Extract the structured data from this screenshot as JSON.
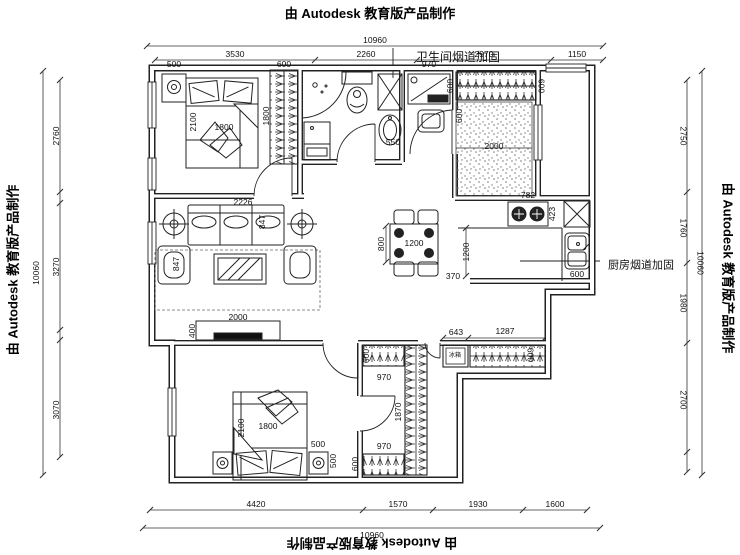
{
  "watermark": {
    "text": "由 Autodesk 教育版产品制作"
  },
  "annotations": {
    "bathroom_flue": "卫生间烟道加固",
    "kitchen_flue": "厨房烟道加固",
    "fridge": "冰箱"
  },
  "dimensions": {
    "top": {
      "total": "10960",
      "segments": [
        "3530",
        "2260",
        "2970",
        "1150"
      ]
    },
    "bottom": {
      "total": "10960",
      "segments": [
        "4420",
        "1570",
        "1930",
        "1600"
      ]
    },
    "left": {
      "total": "10060",
      "segments": [
        "2760",
        "3270",
        "3070"
      ]
    },
    "right": {
      "total": "10060",
      "segments": [
        "2750",
        "1760",
        "1980",
        "2700"
      ]
    }
  },
  "plan_labels": [
    {
      "t": "10960",
      "x": 375,
      "y": 40
    },
    {
      "t": "3530",
      "x": 235,
      "y": 54
    },
    {
      "t": "2260",
      "x": 366,
      "y": 54
    },
    {
      "t": "2970",
      "x": 484,
      "y": 54
    },
    {
      "t": "1150",
      "x": 577,
      "y": 54
    },
    {
      "t": "4420",
      "x": 256,
      "y": 504
    },
    {
      "t": "1570",
      "x": 398,
      "y": 504
    },
    {
      "t": "1930",
      "x": 478,
      "y": 504
    },
    {
      "t": "1600",
      "x": 555,
      "y": 504
    },
    {
      "t": "10960",
      "x": 372,
      "y": 535
    },
    {
      "t": "10060",
      "x": 36,
      "y": 273,
      "r": -90
    },
    {
      "t": "2760",
      "x": 56,
      "y": 136,
      "r": -90
    },
    {
      "t": "3270",
      "x": 56,
      "y": 267,
      "r": -90
    },
    {
      "t": "3070",
      "x": 56,
      "y": 410,
      "r": -90
    },
    {
      "t": "2750",
      "x": 683,
      "y": 136,
      "r": 90
    },
    {
      "t": "1760",
      "x": 683,
      "y": 228,
      "r": 90
    },
    {
      "t": "1980",
      "x": 683,
      "y": 303,
      "r": 90
    },
    {
      "t": "2700",
      "x": 683,
      "y": 400,
      "r": 90
    },
    {
      "t": "10060",
      "x": 700,
      "y": 263,
      "r": 90
    },
    {
      "t": "500",
      "x": 174,
      "y": 64
    },
    {
      "t": "600",
      "x": 284,
      "y": 64
    },
    {
      "t": "2100",
      "x": 193,
      "y": 122,
      "r": -90
    },
    {
      "t": "1800",
      "x": 224,
      "y": 127
    },
    {
      "t": "1800",
      "x": 266,
      "y": 116,
      "r": -90
    },
    {
      "t": "550",
      "x": 393,
      "y": 142
    },
    {
      "t": "970",
      "x": 429,
      "y": 64
    },
    {
      "t": "600",
      "x": 459,
      "y": 116,
      "r": -90
    },
    {
      "t": "600",
      "x": 450,
      "y": 86,
      "r": -90
    },
    {
      "t": "600",
      "x": 541,
      "y": 86,
      "r": 90
    },
    {
      "t": "2000",
      "x": 494,
      "y": 146
    },
    {
      "t": "2226",
      "x": 243,
      "y": 202
    },
    {
      "t": "847",
      "x": 176,
      "y": 264,
      "r": -90
    },
    {
      "t": "847",
      "x": 262,
      "y": 222,
      "r": -90
    },
    {
      "t": "2000",
      "x": 238,
      "y": 317
    },
    {
      "t": "400",
      "x": 192,
      "y": 331,
      "r": -90
    },
    {
      "t": "1200",
      "x": 414,
      "y": 243
    },
    {
      "t": "800",
      "x": 381,
      "y": 244,
      "r": -90
    },
    {
      "t": "1200",
      "x": 466,
      "y": 252,
      "r": -90
    },
    {
      "t": "370",
      "x": 453,
      "y": 276
    },
    {
      "t": "782",
      "x": 528,
      "y": 195
    },
    {
      "t": "423",
      "x": 552,
      "y": 214,
      "r": -90
    },
    {
      "t": "600",
      "x": 577,
      "y": 274
    },
    {
      "t": "1800",
      "x": 268,
      "y": 426
    },
    {
      "t": "2100",
      "x": 241,
      "y": 428,
      "r": -90
    },
    {
      "t": "500",
      "x": 318,
      "y": 444
    },
    {
      "t": "500",
      "x": 333,
      "y": 461,
      "r": -90
    },
    {
      "t": "600",
      "x": 366,
      "y": 356,
      "r": -90
    },
    {
      "t": "970",
      "x": 384,
      "y": 377
    },
    {
      "t": "1870",
      "x": 398,
      "y": 412,
      "r": -90
    },
    {
      "t": "970",
      "x": 384,
      "y": 446
    },
    {
      "t": "600",
      "x": 355,
      "y": 464,
      "r": -90
    },
    {
      "t": "643",
      "x": 456,
      "y": 332
    },
    {
      "t": "1287",
      "x": 505,
      "y": 331
    },
    {
      "t": "600",
      "x": 530,
      "y": 355,
      "r": 90
    },
    {
      "t": "冰箱",
      "x": 455,
      "y": 356,
      "s": 6,
      "n": "fridge-label"
    },
    {
      "t": "卫生间烟道加固",
      "x": 458,
      "y": 57,
      "s": 12,
      "n": "annotation-bathroom-flue"
    },
    {
      "t": "厨房烟道加固",
      "x": 641,
      "y": 266,
      "s": 11,
      "n": "annotation-kitchen-flue"
    }
  ]
}
